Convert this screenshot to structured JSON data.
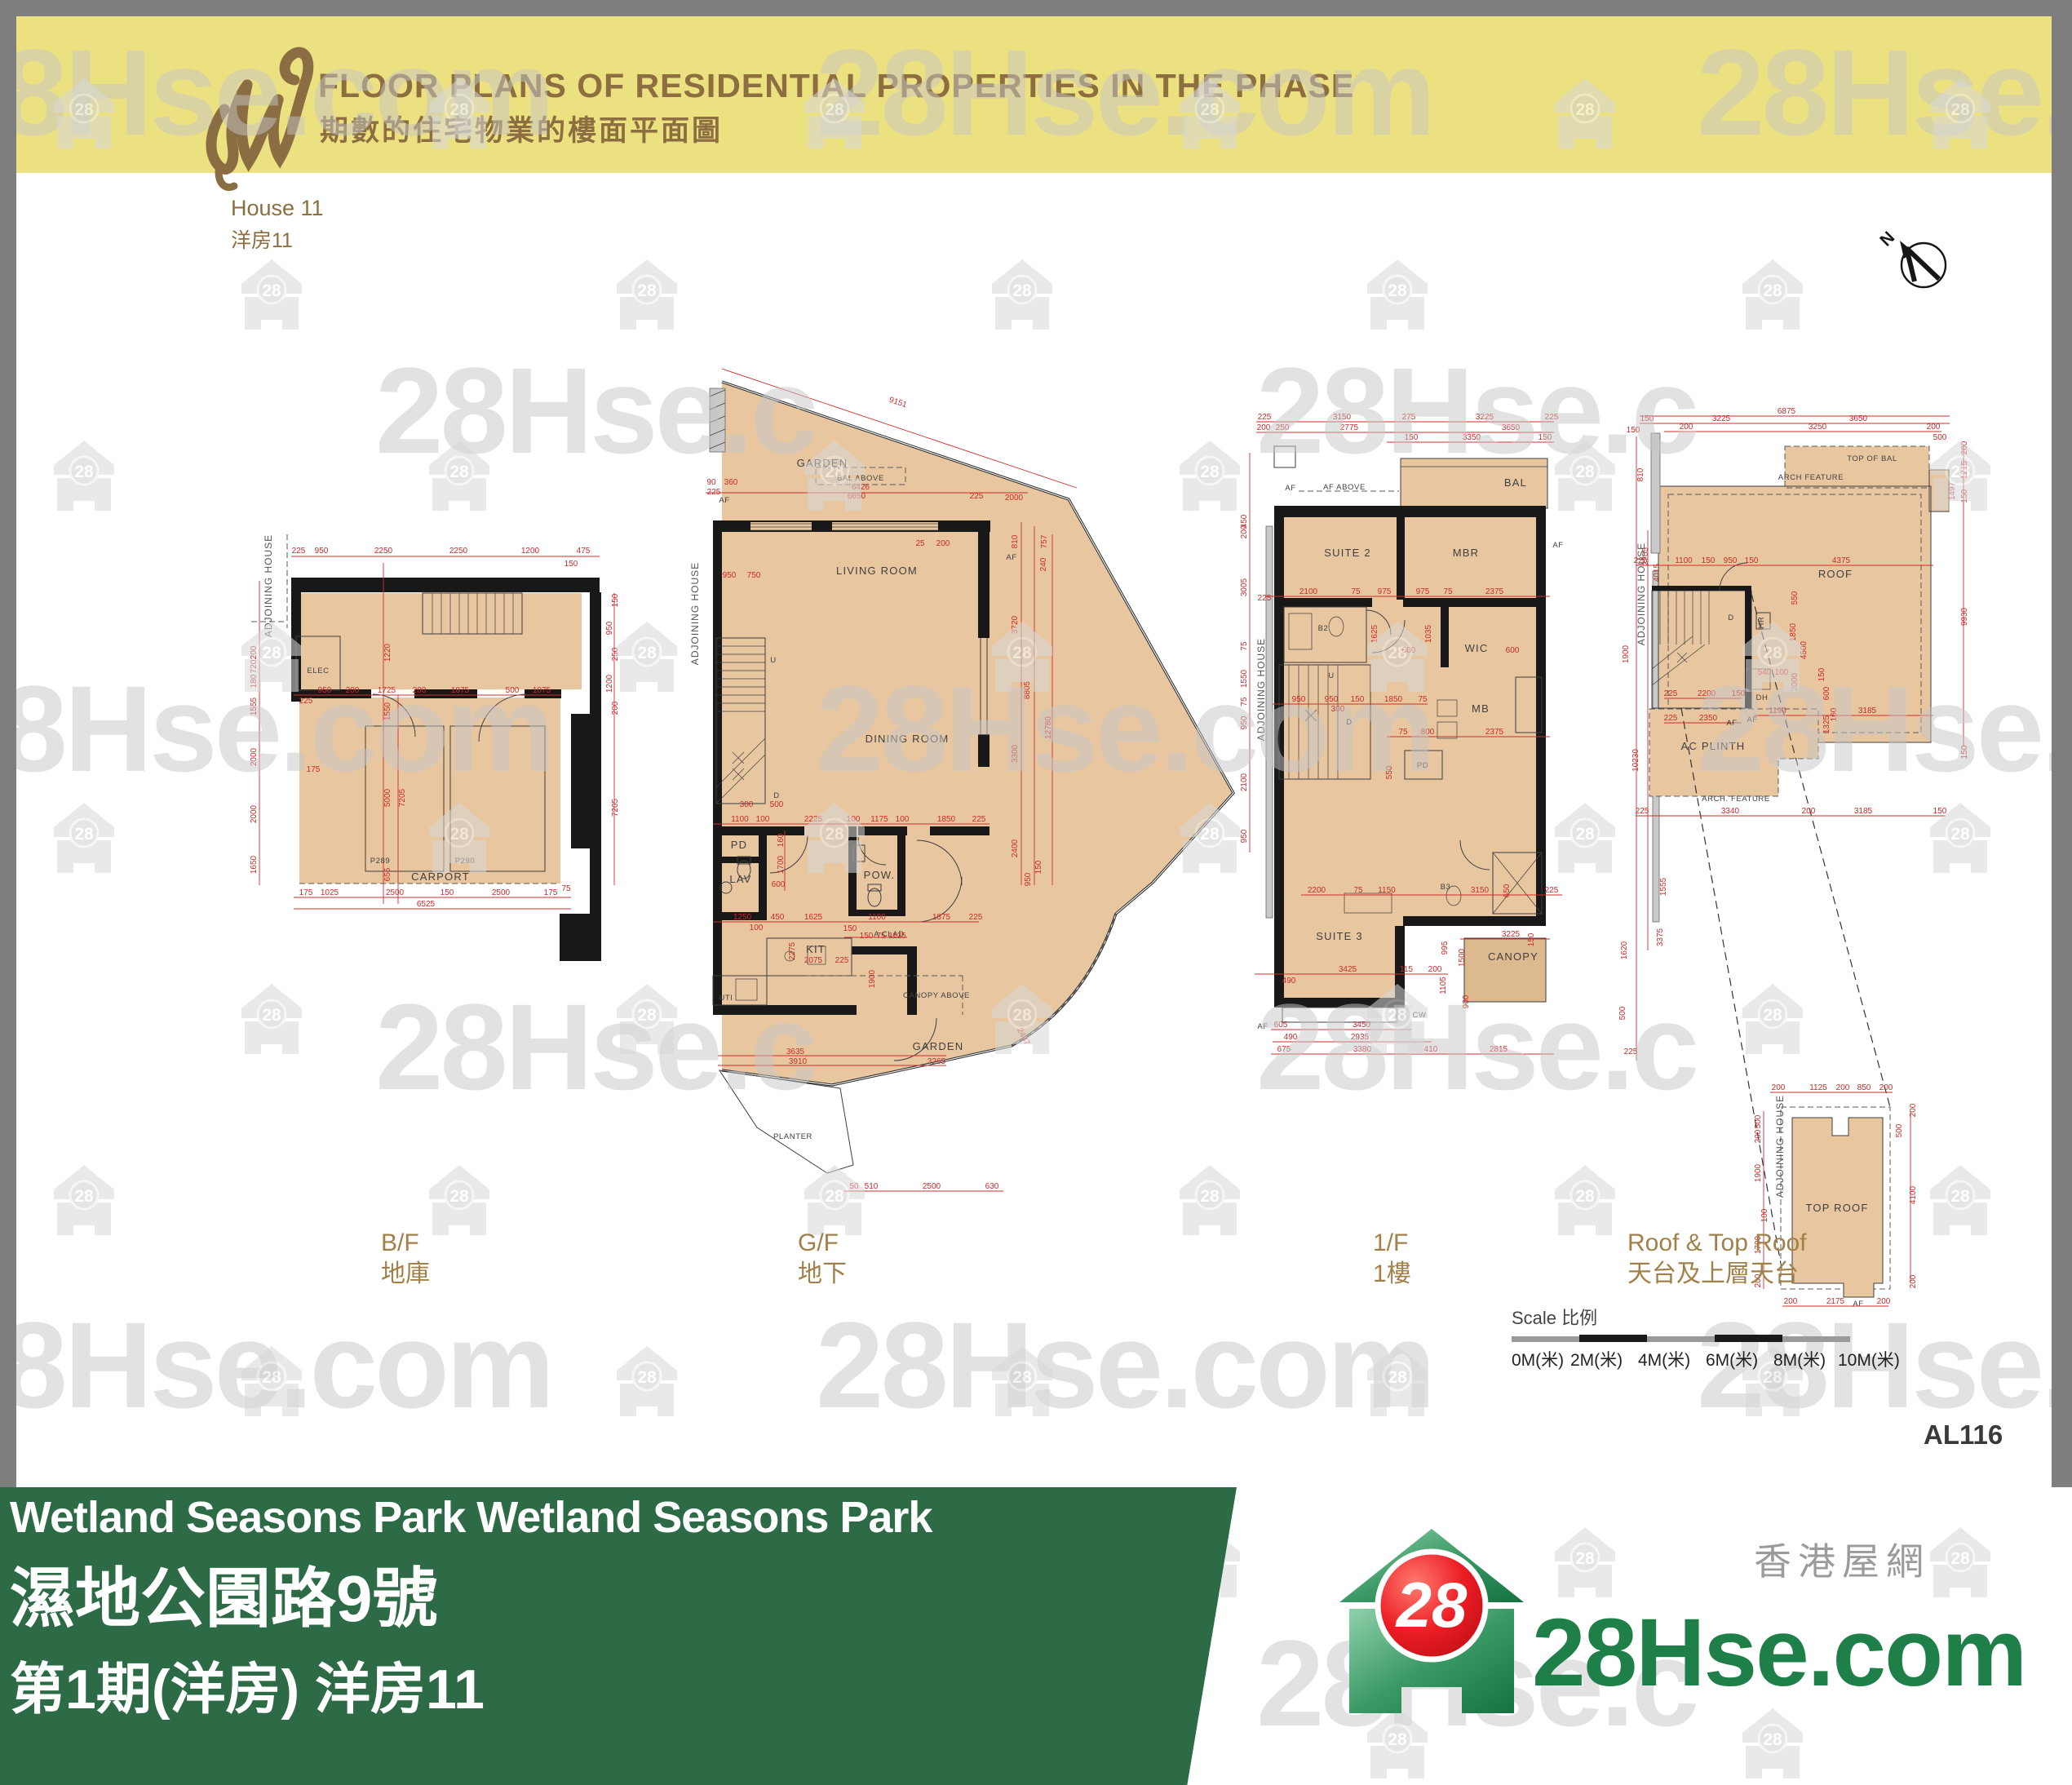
{
  "header": {
    "title": "FLOOR PLANS OF RESIDENTIAL PROPERTIES IN THE PHASE",
    "subtitle_zh": "期數的住宅物業的樓面平面圖",
    "house_en": "House 11",
    "house_zh": "洋房11"
  },
  "compass": {
    "label": "N"
  },
  "watermark": {
    "badge": "28",
    "brand": "28Hse.com"
  },
  "plans": {
    "bf": {
      "caption_en": "B/F",
      "caption_zh": "地庫",
      "labels": {
        "adjoining": "ADJOINING HOUSE",
        "elec": "ELEC",
        "carport": "CARPORT",
        "p289": "P289",
        "p290": "P290"
      },
      "dims": [
        "225",
        "950",
        "2250",
        "2250",
        "1200",
        "475",
        "150",
        "200",
        "720",
        "180",
        "1555",
        "2000",
        "2000",
        "1650",
        "950",
        "200",
        "1725",
        "200",
        "1875",
        "500",
        "1075",
        "225",
        "1220",
        "1550",
        "5000",
        "7205",
        "655",
        "175",
        "175",
        "1025",
        "2500",
        "150",
        "2500",
        "175",
        "6525",
        "75",
        "150",
        "950",
        "250",
        "1200",
        "200",
        "7205"
      ]
    },
    "gf": {
      "caption_en": "G/F",
      "caption_zh": "地下",
      "labels": {
        "garden_top": "GARDEN",
        "bal_above": "BAL ABOVE",
        "af_left": "AF",
        "af_right": "AF",
        "adjoining": "ADJOINING HOUSE",
        "living": "LIVING ROOM",
        "dining": "DINING ROOM",
        "u": "U",
        "d": "D",
        "pd": "PD",
        "lav": "LAV",
        "pow": "POW.",
        "kit": "KIT",
        "uti": "UTI",
        "a_clad": "A CLAD",
        "canopy_above": "CANOPY ABOVE",
        "garden_bottom": "GARDEN",
        "planter": "PLANTER"
      },
      "dims": [
        "9151",
        "6426",
        "6650",
        "90",
        "360",
        "225",
        "225",
        "2000",
        "25",
        "200",
        "810",
        "757",
        "240",
        "3720",
        "8805",
        "12780",
        "3300",
        "2400",
        "950",
        "150",
        "950",
        "750",
        "300",
        "500",
        "1100",
        "100",
        "2225",
        "100",
        "1175",
        "100",
        "1850",
        "225",
        "1250",
        "450",
        "100",
        "1625",
        "1100",
        "150",
        "1875",
        "225",
        "2275",
        "2075",
        "225",
        "150",
        "75",
        "1125",
        "1900",
        "3635",
        "3910",
        "3265",
        "2437",
        "50",
        "510",
        "2500",
        "630",
        "600",
        "1700",
        "160"
      ]
    },
    "ff": {
      "caption_en": "1/F",
      "caption_zh": "1樓",
      "labels": {
        "af_above": "AF ABOVE",
        "af_left": "AF",
        "bal": "BAL",
        "suite2": "SUITE 2",
        "mbr": "MBR",
        "b2": "B2",
        "wic": "WIC",
        "u": "U",
        "d": "D",
        "mb": "MB",
        "pd": "PD",
        "b3": "B3",
        "suite3": "SUITE 3",
        "canopy": "CANOPY",
        "cw": "CW",
        "af_right": "AF",
        "af_bottom": "AF",
        "adjoining_l": "ADJOINING HOUSE",
        "adjoining_r": "ADJOINING HOUSE"
      },
      "dims": [
        "225",
        "3150",
        "275",
        "3225",
        "225",
        "200",
        "250",
        "2775",
        "3650",
        "150",
        "3350",
        "150",
        "450",
        "200",
        "3005",
        "75",
        "1550",
        "75",
        "950",
        "2100",
        "950",
        "225",
        "2100",
        "75",
        "975",
        "975",
        "75",
        "2375",
        "1625",
        "1035",
        "600",
        "600",
        "950",
        "950",
        "150",
        "1850",
        "75",
        "300",
        "75",
        "800",
        "2375",
        "550",
        "2200",
        "75",
        "1150",
        "3150",
        "650",
        "225",
        "3425",
        "115",
        "200",
        "490",
        "995",
        "1500",
        "3225",
        "150",
        "1105",
        "900",
        "605",
        "3450",
        "490",
        "2935",
        "675",
        "3380",
        "410",
        "2815",
        "150",
        "810",
        "2705",
        "4015",
        "1900",
        "10230",
        "3700",
        "1555",
        "3375",
        "1620",
        "500",
        "225"
      ]
    },
    "roof": {
      "caption_en": "Roof & Top Roof",
      "caption_zh": "天台及上層天台",
      "labels": {
        "top_of_bal": "TOP OF BAL",
        "arch_feature": "ARCH  FEATURE",
        "roof": "ROOF",
        "adjoining": "ADJOINING HOUSE",
        "d": "D",
        "hr": "HR",
        "dh": "DH",
        "af": "AF",
        "af2": "AF",
        "ac_plinth": "AC PLINTH",
        "arch_feature2": "ARCH. FEATURE",
        "toproof": "TOP ROOF",
        "adjoining2": "ADJOINING HOUSE",
        "af3": "AF"
      },
      "dims": [
        "6875",
        "150",
        "3225",
        "3650",
        "200",
        "3250",
        "200",
        "500",
        "200",
        "1215",
        "1497",
        "150",
        "225",
        "1100",
        "150",
        "950",
        "150",
        "4375",
        "550",
        "1850",
        "4500",
        "2000",
        "540",
        "100",
        "150",
        "600",
        "160",
        "225",
        "2200",
        "150",
        "1190",
        "3185",
        "1325",
        "225",
        "2350",
        "225",
        "3340",
        "200",
        "3185",
        "150",
        "9930",
        "150",
        "200",
        "1125",
        "200",
        "850",
        "200",
        "500",
        "200",
        "1900",
        "100",
        "1700",
        "200",
        "200",
        "500",
        "4100",
        "200",
        "200",
        "2175",
        "200"
      ]
    }
  },
  "scalebar": {
    "label": "Scale 比例",
    "ticks": [
      "0M(米)",
      "2M(米)",
      "4M(米)",
      "6M(米)",
      "8M(米)",
      "10M(米)"
    ]
  },
  "sheet_no": "AL116",
  "footer": {
    "line1": "Wetland Seasons Park Wetland Seasons Park",
    "line2": "濕地公園路9號",
    "line3": "第1期(洋房) 洋房11",
    "logo_badge": "28",
    "logo_brand": "28Hse.com",
    "logo_zh": "香港屋網"
  }
}
